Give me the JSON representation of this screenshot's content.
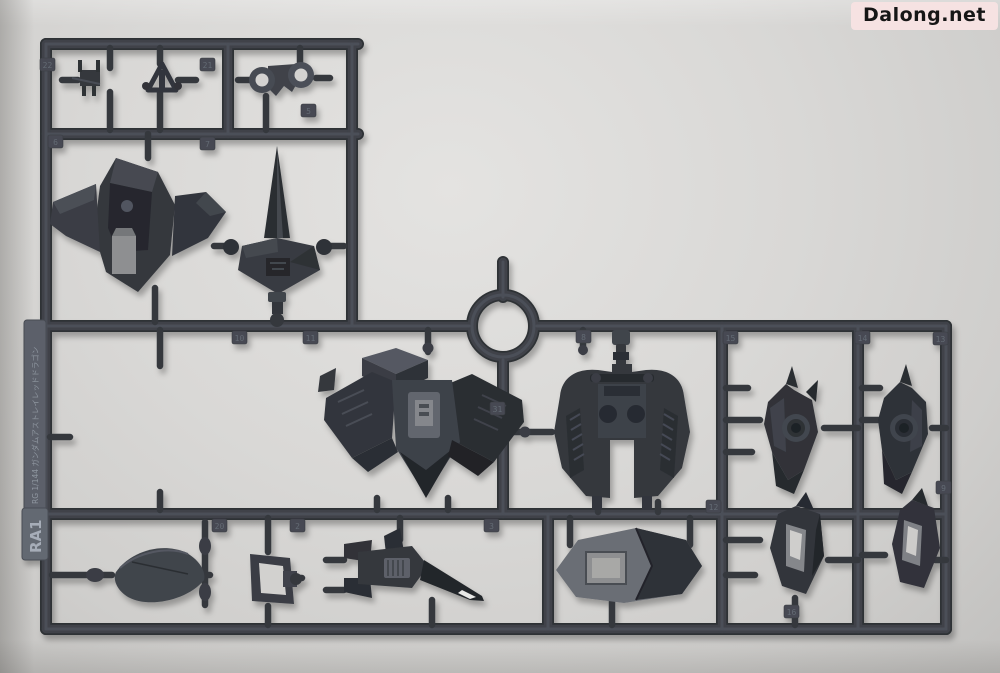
{
  "watermark": {
    "text": "Dalong.net",
    "bg_color": "#f6e2e2",
    "text_color": "#161616"
  },
  "runner": {
    "tag_id": "RA1",
    "kit_label": "RG 1/144 ガンダムアストレイレッドドラゴン",
    "plastic_color": "#3a3d43",
    "background_color": "#d9d8d6",
    "part_tabs": [
      "22",
      "21",
      "5",
      "6",
      "7",
      "10",
      "11",
      "8",
      "15",
      "14",
      "31",
      "13",
      "20",
      "2",
      "3",
      "12",
      "16",
      "9"
    ]
  }
}
